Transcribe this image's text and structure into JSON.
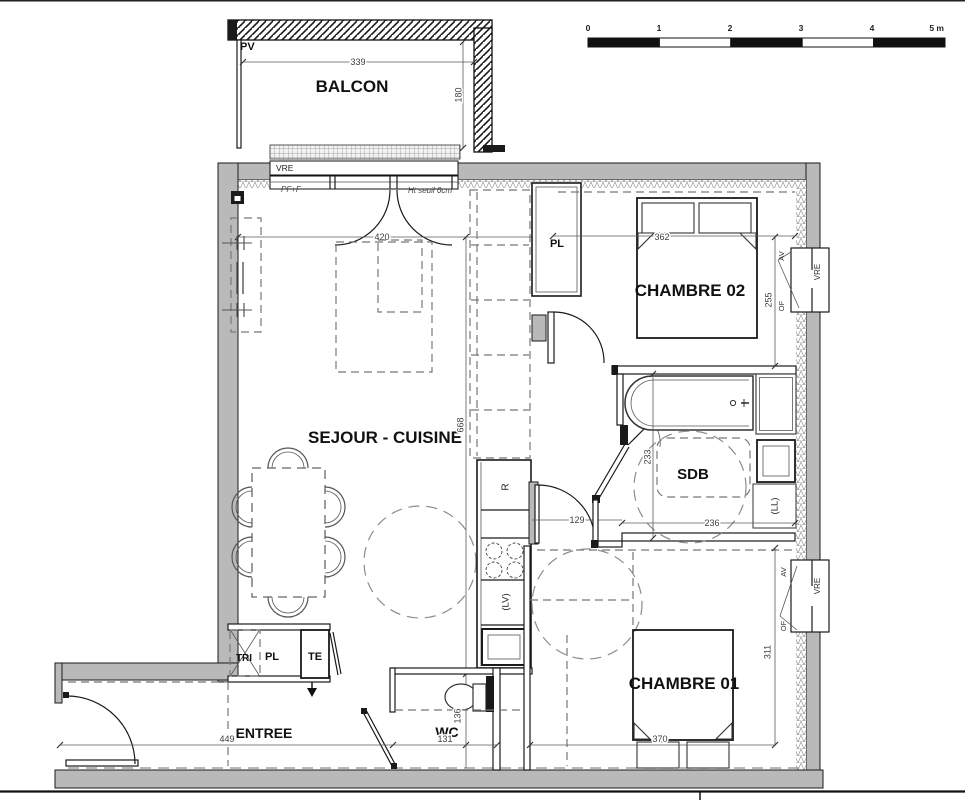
{
  "title": "Plan appartement T3",
  "labels": {
    "pv": "PV",
    "balcon": "BALCON",
    "vre": "VRE",
    "pf_f": "PF+F",
    "ht_seuil": "Ht seuil 6cm",
    "sejour": "SEJOUR - CUISINE",
    "chambre02": "CHAMBRE 02",
    "chambre01": "CHAMBRE 01",
    "sdb": "SDB",
    "wc": "WC",
    "entree": "ENTREE",
    "pl": "PL",
    "tri": "TRI",
    "te": "TE",
    "fridge": "R",
    "dishwasher": "(LV)",
    "washer": "(LL)",
    "av": "AV",
    "of": "OF"
  },
  "dims": {
    "balcon_width": "339",
    "balcon_depth": "180",
    "sejour_width": "420",
    "sejour_length": "668",
    "chambre02_width": "362",
    "chambre02_depth": "255",
    "hall_door": "129",
    "sdb_depth": "233",
    "sdb_width": "236",
    "chambre01_depth": "311",
    "chambre01_width": "370",
    "entree_width": "449",
    "wc_width": "131",
    "wc_depth": "136"
  },
  "scale_bar": {
    "ticks": [
      "0",
      "1",
      "2",
      "3",
      "4",
      "5 m"
    ]
  }
}
